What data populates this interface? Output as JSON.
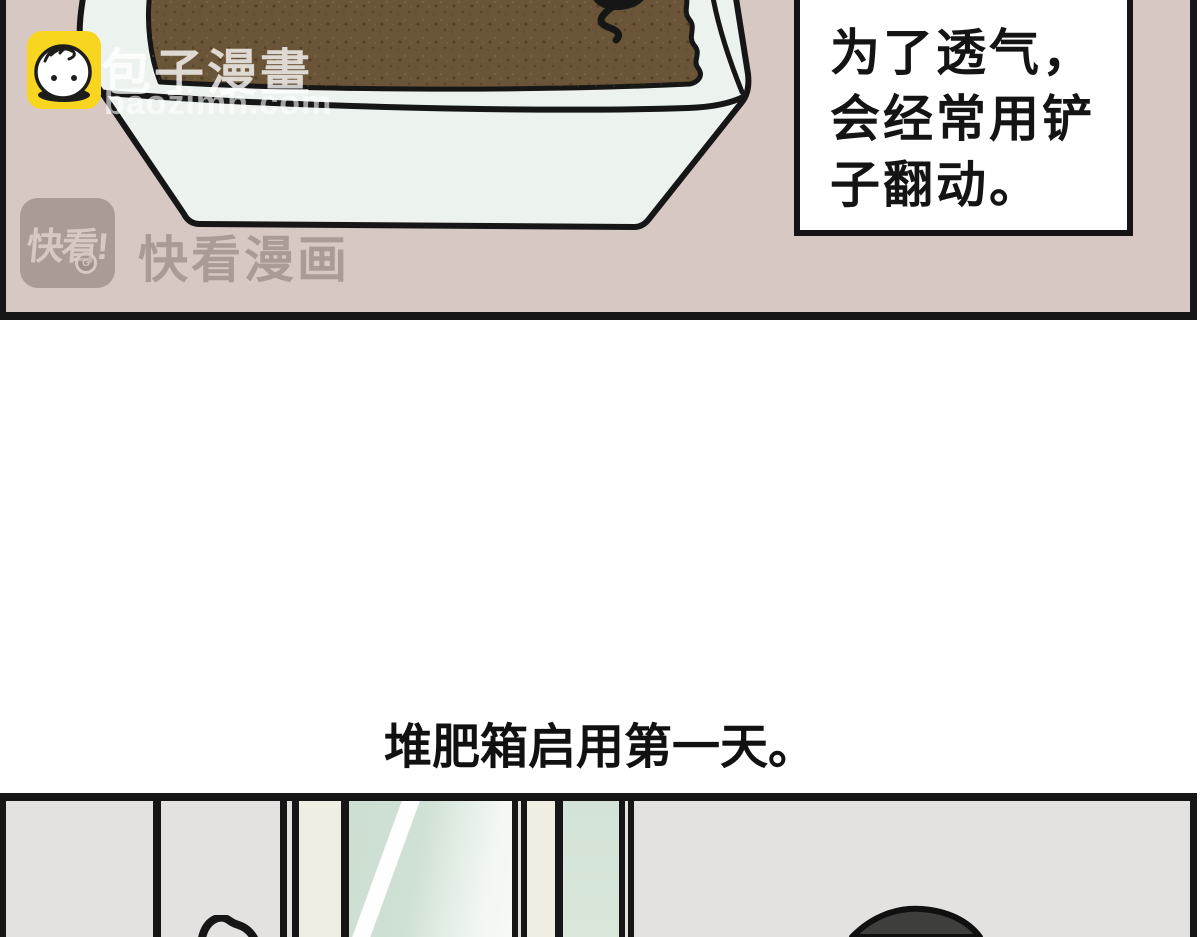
{
  "comic": {
    "panel1": {
      "caption_lines": [
        "为了透气，",
        "会经常用铲",
        "子翻动。"
      ]
    },
    "narration": "堆肥箱启用第一天。",
    "watermarks": {
      "baozi_name": "包子漫畫",
      "baozi_domain": "baozimh.com",
      "kuaikan_logo": "快看!",
      "kuaikan_badge": "G",
      "kuaikan_name": "快看漫画"
    },
    "colors": {
      "panel1_bg": "#d7c8c4",
      "soil_brown": "#6b5538",
      "tub_white": "#ecf3ef",
      "wall_gray": "#e3e2e0",
      "window_trim": "#f0ede3",
      "glass_green": "#cfe0d4",
      "cat_gray": "#3e3e3c",
      "outline_ink": "#161616",
      "baozi_yellow": "#f8d51f"
    }
  }
}
